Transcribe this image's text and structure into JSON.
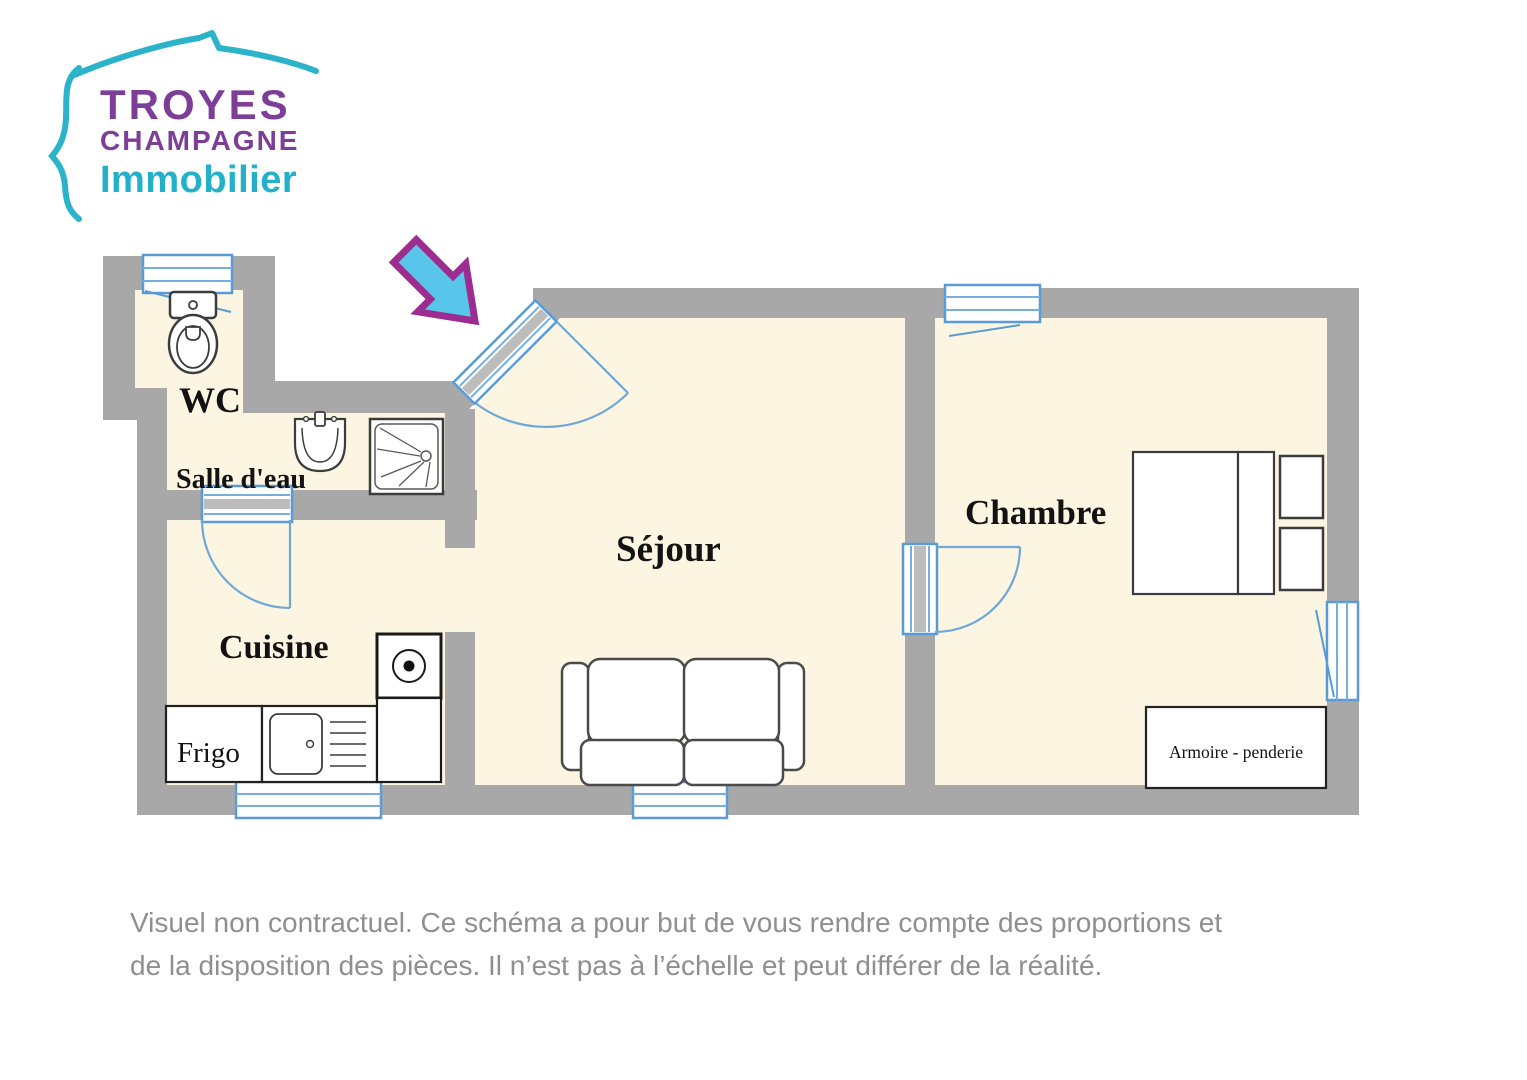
{
  "logo": {
    "brand_top": "TROYES",
    "brand_mid": "CHAMPAGNE",
    "brand_bottom": "Immobilier"
  },
  "plan": {
    "labels": {
      "wc": "WC",
      "salle_deau": "Salle d'eau",
      "cuisine": "Cuisine",
      "sejour": "Séjour",
      "chambre": "Chambre",
      "frigo": "Frigo",
      "armoire": "Armoire - penderie"
    }
  },
  "disclaimer": {
    "line1": "Visuel non contractuel. Ce schéma a pour but de vous rendre compte des proportions et",
    "line2": "de la disposition des pièces. Il n’est pas à l’échelle et peut différer de la réalité."
  },
  "colors": {
    "wall_gray": "#a8a8a8",
    "room_cream": "#fcf5e1",
    "window_blue": "#5b9bd5",
    "door_arc_blue": "#6fa8d8",
    "arrow_fill": "#58c6ea",
    "arrow_stroke": "#9d2c90",
    "logo_purple": "#7c3e97",
    "logo_teal": "#22b1c9",
    "disclaimer_gray": "#8f8f8f"
  }
}
